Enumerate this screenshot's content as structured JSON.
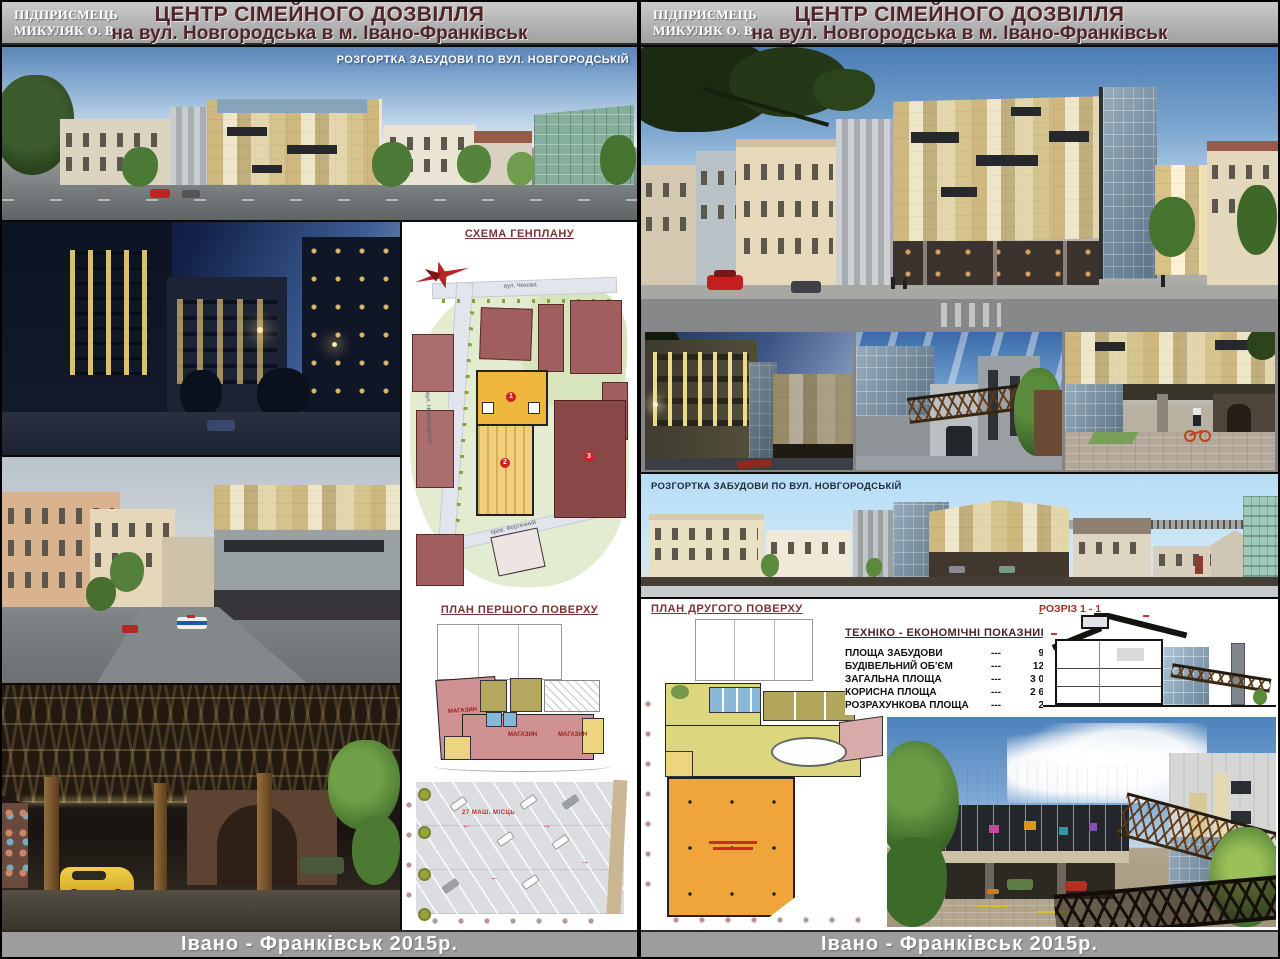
{
  "header": {
    "company_line1": "ПІДПРИЄМЕЦЬ",
    "company_line2": "МИКУЛЯК О. В.",
    "title": "ЦЕНТР СІМЕЙНОГО ДОЗВІЛЛЯ",
    "subtitle": "на вул. Новгородська  в м. Івано-Франківськ"
  },
  "footer": {
    "text": "Івано - Франківськ   2015р."
  },
  "left_panel": {
    "elevation_label": "РОЗГОРТКА ЗАБУДОВИ ПО ВУЛ. НОВГОРОДСЬКІЙ",
    "genplan": {
      "title": "СХЕМА ГЕНПЛАНУ",
      "street_top": "вул. Чехова",
      "street_left": "вул. Новгородська",
      "street_lane": "пров. Фортечний",
      "markers": [
        "1",
        "2",
        "3"
      ]
    },
    "first_floor": {
      "title": "ПЛАН ПЕРШОГО ПОВЕРХУ",
      "rooms": [
        "МАГАЗИН",
        "МАГАЗИН",
        "МАГАЗИН"
      ],
      "parking_note": "27 МАШ. МІСЦЬ"
    }
  },
  "right_panel": {
    "elevation_label": "РОЗГОРТКА ЗАБУДОВИ ПО ВУЛ. НОВГОРОДСЬКІЙ",
    "second_floor": {
      "title": "ПЛАН ДРУГОГО ПОВЕРХУ"
    },
    "indicators": {
      "title": "ТЕХНІКО - ЕКОНОМІЧНІ  ПОКАЗНИКИ",
      "rows": [
        {
          "label": "ПЛОЩА  ЗАБУДОВИ",
          "dashes": "---",
          "value": "959,6 м²"
        },
        {
          "label": "БУДІВЕЛЬНИЙ  ОБ'ЄМ",
          "dashes": "---",
          "value": "12 395 м³"
        },
        {
          "label": "ЗАГАЛЬНА  ПЛОЩА",
          "dashes": "---",
          "value": "3 075,3 м²"
        },
        {
          "label": "КОРИСНА  ПЛОЩА",
          "dashes": "---",
          "value": "2 642,2 м²"
        },
        {
          "label": "РОЗРАХУНКОВА  ПЛОЩА",
          "dashes": "---",
          "value": "2 322 м²"
        }
      ]
    },
    "section": {
      "title": "РОЗРІЗ 1 - 1"
    }
  }
}
